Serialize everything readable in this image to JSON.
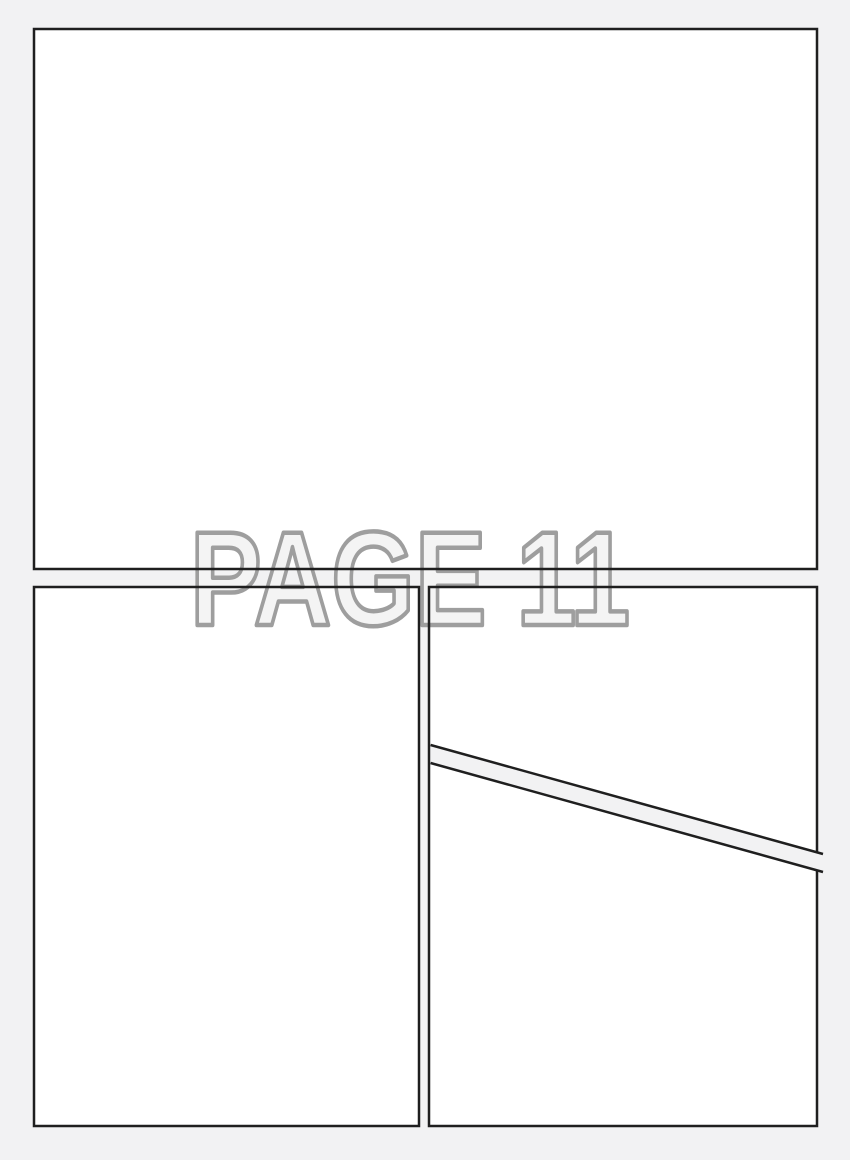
{
  "page": {
    "kind": "comic-page-layout-template",
    "watermark": {
      "text": "PAGE 11"
    },
    "colors": {
      "background": "#f2f2f3",
      "panel_fill": "#ffffff",
      "panel_border": "#1f1f1f",
      "watermark_fill": "#f4f4f4",
      "watermark_outline": "#9e9e9e"
    },
    "panels": [
      {
        "id": "top-panel",
        "shape": "rectangle"
      },
      {
        "id": "bottom-left-panel",
        "shape": "rectangle"
      },
      {
        "id": "bottom-right-upper-panel",
        "shape": "rectangle-cut-by-diagonal"
      },
      {
        "id": "bottom-right-lower-panel",
        "shape": "rectangle-cut-by-diagonal"
      }
    ]
  }
}
